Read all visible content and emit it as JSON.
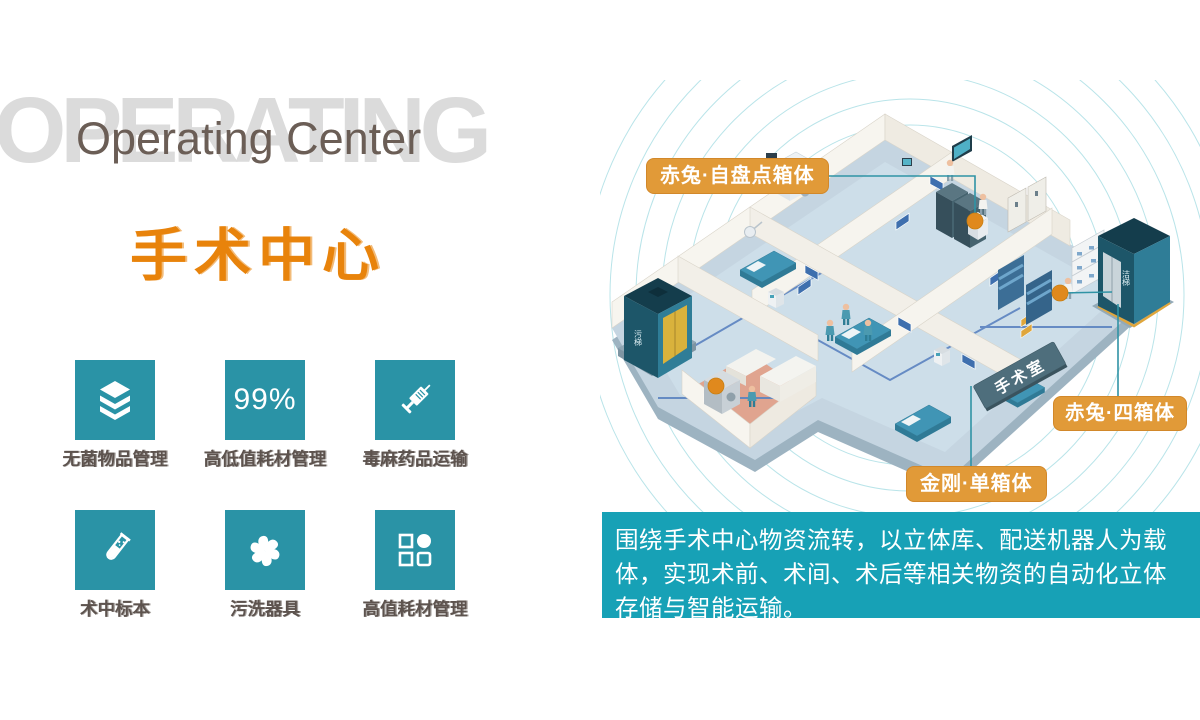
{
  "header": {
    "bg_word": "OPERATING",
    "subtitle": "Operating Center",
    "title_cn": "手术中心"
  },
  "features": [
    {
      "icon": "layers-icon",
      "label": "无菌物品管理"
    },
    {
      "icon": "percent-badge",
      "label": "高低值耗材管理",
      "value": "99%"
    },
    {
      "icon": "syringe-icon",
      "label": "毒麻药品运输"
    },
    {
      "icon": "test-tube-icon",
      "label": "术中标本"
    },
    {
      "icon": "fan-icon",
      "label": "污洗器具"
    },
    {
      "icon": "grid-icon",
      "label": "高值耗材管理"
    }
  ],
  "diagram": {
    "callouts": [
      {
        "label": "赤兔·自盘点箱体"
      },
      {
        "label": "赤兔·四箱体"
      },
      {
        "label": "金刚·单箱体"
      }
    ],
    "room_tag": "手术室",
    "elevator_left": "污梯",
    "elevator_right": "洁梯"
  },
  "description": "围绕手术中心物资流转，以立体库、配送机器人为载体，实现术前、术间、术后等相关物资的自动化立体存储与智能运输。",
  "colors": {
    "accent_orange": "#E8830B",
    "tile_teal": "#2A93A6",
    "panel_teal": "#17A1B6",
    "callout_amber": "#E19A38",
    "marker_orange": "#E0891D"
  }
}
